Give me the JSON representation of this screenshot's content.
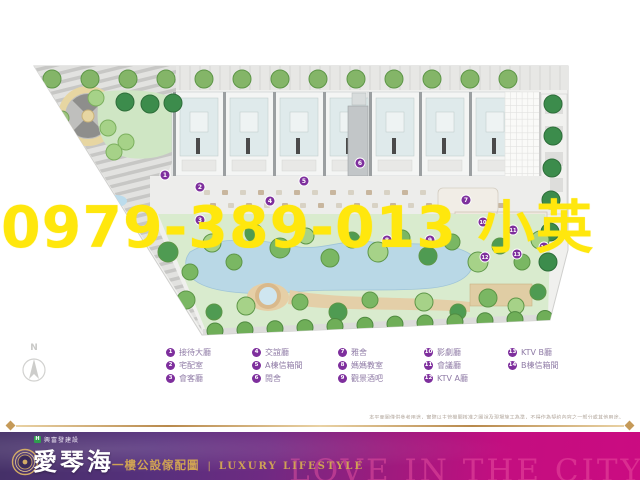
{
  "watermark": {
    "text": "0979-389-013 小英",
    "color": "#ffe70d"
  },
  "compass": {
    "label": "N"
  },
  "legend": {
    "marker_color": "#7e2f9d",
    "columns": [
      [
        {
          "num": "1",
          "label": "接待大廳"
        },
        {
          "num": "2",
          "label": "宅配室"
        },
        {
          "num": "3",
          "label": "會客廳"
        }
      ],
      [
        {
          "num": "4",
          "label": "交誼廳"
        },
        {
          "num": "5",
          "label": "A棟信箱間"
        },
        {
          "num": "6",
          "label": "閱舍"
        }
      ],
      [
        {
          "num": "7",
          "label": "雅舍"
        },
        {
          "num": "8",
          "label": "媽媽教室"
        },
        {
          "num": "9",
          "label": "觀景酒吧"
        }
      ],
      [
        {
          "num": "10",
          "label": "影劇廳"
        },
        {
          "num": "11",
          "label": "會議廳"
        },
        {
          "num": "12",
          "label": "KTV A廳"
        }
      ],
      [
        {
          "num": "13",
          "label": "KTV B廳"
        },
        {
          "num": "14",
          "label": "B棟信箱間"
        }
      ]
    ]
  },
  "plan": {
    "markers": [
      {
        "n": "1",
        "x": 165,
        "y": 175
      },
      {
        "n": "2",
        "x": 200,
        "y": 187
      },
      {
        "n": "3",
        "x": 200,
        "y": 220
      },
      {
        "n": "4",
        "x": 270,
        "y": 201
      },
      {
        "n": "5",
        "x": 304,
        "y": 181
      },
      {
        "n": "6",
        "x": 360,
        "y": 163
      },
      {
        "n": "7",
        "x": 466,
        "y": 200
      },
      {
        "n": "8",
        "x": 387,
        "y": 240
      },
      {
        "n": "9",
        "x": 430,
        "y": 240
      },
      {
        "n": "10",
        "x": 483,
        "y": 222
      },
      {
        "n": "11",
        "x": 513,
        "y": 230
      },
      {
        "n": "12",
        "x": 485,
        "y": 257
      },
      {
        "n": "13",
        "x": 517,
        "y": 254
      },
      {
        "n": "14",
        "x": 544,
        "y": 247
      }
    ]
  },
  "disclaimer": "本平面圖僅供參考用途，實際以主管機關核准之圖說及現場施工為準，不得作為契約內容之一部分或其他用途。",
  "banner": {
    "developer": "興富發建設",
    "project": "愛琴海",
    "subtitle": "一樓公設傢配圖",
    "separator": "|",
    "tagline": "LUXURY LIFESTYLE",
    "background_text": "LOVE IN THE CITY",
    "gradient_left": "#443067",
    "gradient_right": "#cb0b81",
    "gold": "#cfa254"
  }
}
